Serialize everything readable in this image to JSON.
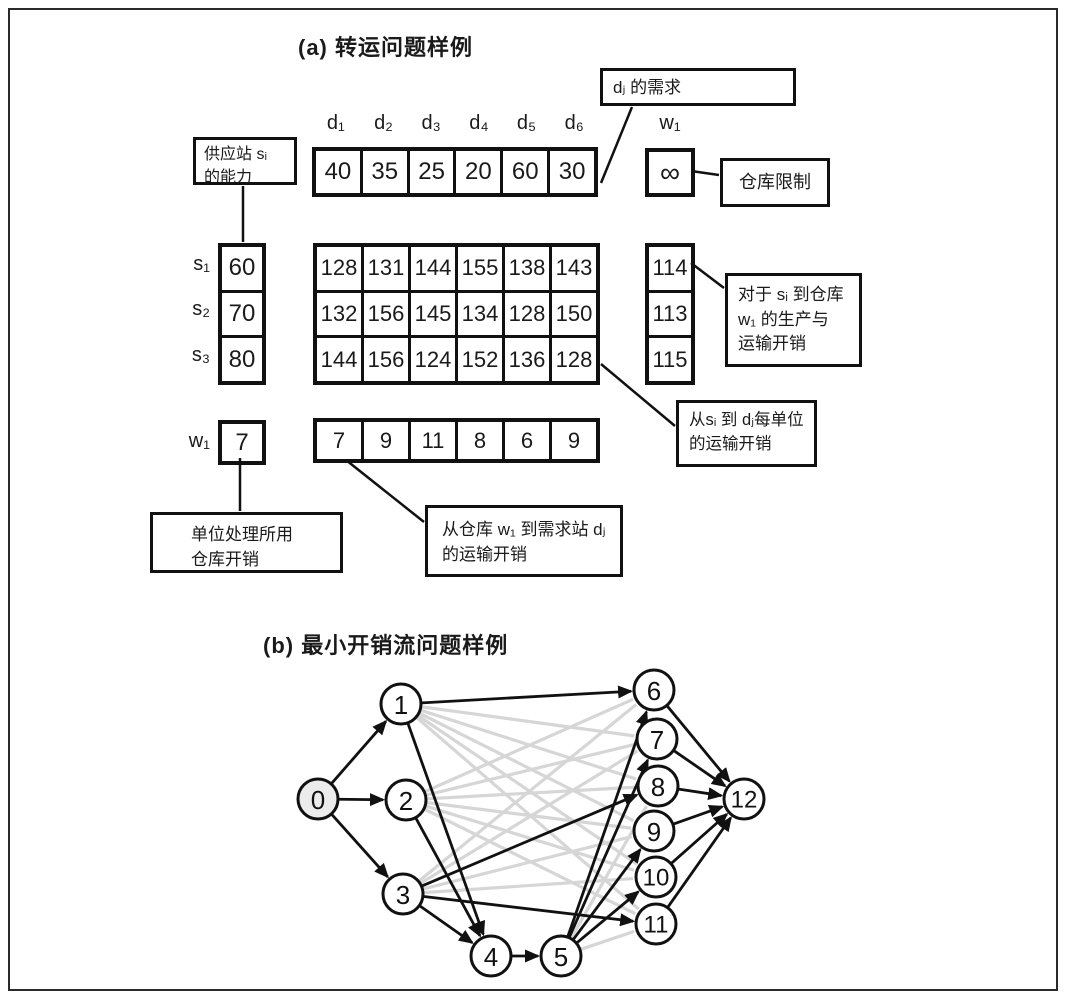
{
  "colors": {
    "ink": "#111111",
    "gray_edge": "#d6d6d6",
    "border": "#2a2a2a"
  },
  "section_a": {
    "title": "(a) 转运问题样例",
    "demand_headers": [
      "d₁",
      "d₂",
      "d₃",
      "d₄",
      "d₅",
      "d₆"
    ],
    "demand_values": [
      "40",
      "35",
      "25",
      "20",
      "60",
      "30"
    ],
    "warehouse_header": "w₁",
    "warehouse_capacity": "∞",
    "supply_labels": [
      "s₁",
      "s₂",
      "s₃"
    ],
    "supply_values": [
      "60",
      "70",
      "80"
    ],
    "cost_matrix": [
      [
        "128",
        "131",
        "144",
        "155",
        "138",
        "143"
      ],
      [
        "132",
        "156",
        "145",
        "134",
        "128",
        "150"
      ],
      [
        "144",
        "156",
        "124",
        "152",
        "136",
        "128"
      ]
    ],
    "warehouse_costs": [
      "114",
      "113",
      "115"
    ],
    "warehouse_row_label": "w₁",
    "warehouse_unit_cost": "7",
    "warehouse_to_demand_costs": [
      "7",
      "9",
      "11",
      "8",
      "6",
      "9"
    ],
    "callouts": {
      "supply": {
        "lines": [
          "供应站 sᵢ",
          "的能力"
        ]
      },
      "demand": {
        "lines": [
          "dⱼ 的需求"
        ]
      },
      "warehouse_limit": {
        "lines": [
          "仓库限制"
        ]
      },
      "prod_cost": {
        "lines": [
          "对于 sᵢ 到仓库",
          "w₁ 的生产与",
          "运输开销"
        ]
      },
      "unit_cost": {
        "lines": [
          "从sᵢ 到 dⱼ每单位",
          "的运输开销"
        ]
      },
      "w_to_d": {
        "lines": [
          "从仓库 w₁ 到需求站 dⱼ",
          "的运输开销"
        ]
      },
      "warehouse_unit": {
        "lines": [
          "单位处理所用",
          "仓库开销"
        ]
      }
    }
  },
  "section_b": {
    "title": "(b) 最小开销流问题样例",
    "graph": {
      "nodes": [
        {
          "id": "0",
          "x": 318,
          "y": 799
        },
        {
          "id": "1",
          "x": 401,
          "y": 704
        },
        {
          "id": "2",
          "x": 406,
          "y": 800
        },
        {
          "id": "3",
          "x": 403,
          "y": 894
        },
        {
          "id": "4",
          "x": 491,
          "y": 956
        },
        {
          "id": "5",
          "x": 561,
          "y": 956
        },
        {
          "id": "6",
          "x": 654,
          "y": 690
        },
        {
          "id": "7",
          "x": 657,
          "y": 739
        },
        {
          "id": "8",
          "x": 658,
          "y": 786
        },
        {
          "id": "9",
          "x": 654,
          "y": 831
        },
        {
          "id": "10",
          "x": 656,
          "y": 877
        },
        {
          "id": "11",
          "x": 656,
          "y": 924
        },
        {
          "id": "12",
          "x": 744,
          "y": 799
        }
      ],
      "black_edges": [
        [
          "0",
          "1"
        ],
        [
          "0",
          "2"
        ],
        [
          "0",
          "3"
        ],
        [
          "1",
          "4"
        ],
        [
          "1",
          "6"
        ],
        [
          "2",
          "4"
        ],
        [
          "3",
          "4"
        ],
        [
          "3",
          "8"
        ],
        [
          "3",
          "11"
        ],
        [
          "4",
          "5"
        ],
        [
          "5",
          "6"
        ],
        [
          "5",
          "7"
        ],
        [
          "5",
          "9"
        ],
        [
          "5",
          "10"
        ],
        [
          "6",
          "12"
        ],
        [
          "7",
          "12"
        ],
        [
          "8",
          "12"
        ],
        [
          "9",
          "12"
        ],
        [
          "10",
          "12"
        ],
        [
          "11",
          "12"
        ]
      ],
      "gray_edges": [
        [
          "1",
          "7"
        ],
        [
          "1",
          "8"
        ],
        [
          "1",
          "9"
        ],
        [
          "1",
          "10"
        ],
        [
          "1",
          "11"
        ],
        [
          "2",
          "6"
        ],
        [
          "2",
          "7"
        ],
        [
          "2",
          "8"
        ],
        [
          "2",
          "9"
        ],
        [
          "2",
          "10"
        ],
        [
          "2",
          "11"
        ],
        [
          "3",
          "6"
        ],
        [
          "3",
          "7"
        ],
        [
          "3",
          "9"
        ],
        [
          "3",
          "10"
        ],
        [
          "5",
          "8"
        ],
        [
          "5",
          "11"
        ]
      ]
    }
  }
}
